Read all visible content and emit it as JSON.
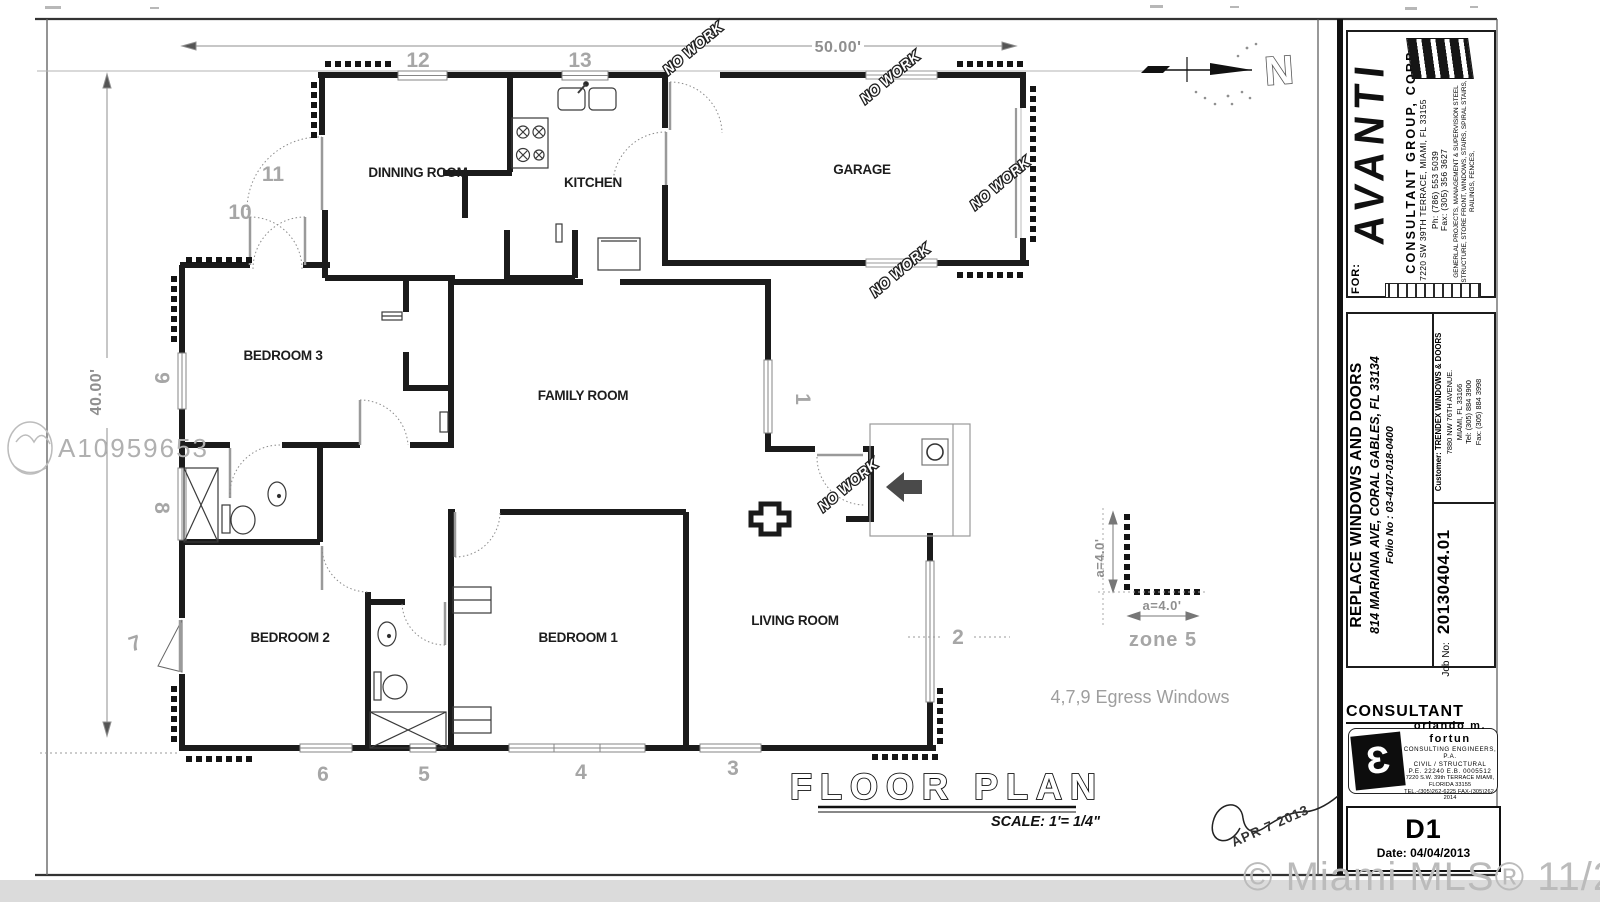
{
  "sheet": {
    "title": "FLOOR PLAN",
    "scale": "SCALE: 1'= 1/4\"",
    "approval_stamp": "APR  7 2013",
    "north": "N"
  },
  "plan": {
    "rooms": {
      "dinning": "DINNING ROOM",
      "kitchen": "KITCHEN",
      "garage": "GARAGE",
      "bedroom3": "BEDROOM 3",
      "family": "FAMILY ROOM",
      "bedroom2": "BEDROOM 2",
      "bedroom1": "BEDROOM 1",
      "living": "LIVING ROOM"
    },
    "dims": {
      "width": "50.00'",
      "height": "40.00'"
    },
    "openings": [
      "1",
      "2",
      "3",
      "4",
      "5",
      "6",
      "7",
      "8",
      "9",
      "10",
      "11",
      "12",
      "13"
    ],
    "no_work": "NO WORK",
    "legend": {
      "a_v": "a=4.0'",
      "a_h": "a=4.0'",
      "zone": "zone 5"
    },
    "egress_note": "4,7,9 Egress Windows"
  },
  "title_block": {
    "for_label": "FOR:",
    "firm": {
      "logo": "AVANTI",
      "name": "CONSULTANT GROUP, CORP.",
      "address": "7220 SW 39TH TERRACE, MIAMI, FL 33155",
      "phone": "Ph: (786) 553 5039",
      "fax": "Fax: (305) 356 3627",
      "services": "GENERLAL PROJECTS, MANAGEMENT & SUPERVISION STEEL STRUCTURE, STORE FRONT, WINDOWS, STAIRS, SPIRAL STAIRS, RAILINGS, FENCES,"
    },
    "project": {
      "title": "REPLACE WINDOWS AND DOORS",
      "address": "814 MARIANA AVE, CORAL GABLES, FL  33134",
      "folio": "Folio No : 03-4107-018-0400"
    },
    "customer": {
      "label": "Customer:",
      "name": "TRENDEX WINDOWS & DOORS",
      "address1": "7880 NW 76TH AVENUE.",
      "address2": "MIAMI, FL 33166",
      "tel": "Tel: (305) 884 3900",
      "fax": "Fax: (305) 884 3998"
    },
    "job": {
      "label": "Job No:",
      "number": "20130404.01"
    },
    "consultant": {
      "heading": "CONSULTANT",
      "stamp_name": "orlando m. fortun",
      "stamp_line1": "CONSULTING ENGINEERS, P.A.",
      "stamp_line2": "CIVIL / STRUCTURAL",
      "stamp_line3": "P.E. 22240      E.B. 0005512",
      "stamp_line4": "7220 S.W. 39th TERRACE MIAMI, FLORIDA 33155",
      "stamp_line5": "TEL.-(305)262-6225   FAX-(305)262-2014"
    },
    "sheet_no": "D1",
    "sheet_date": "Date: 04/04/2013"
  },
  "watermarks": {
    "listing_id": "A10959653",
    "mls": "© Miami MLS® 11/2020"
  }
}
